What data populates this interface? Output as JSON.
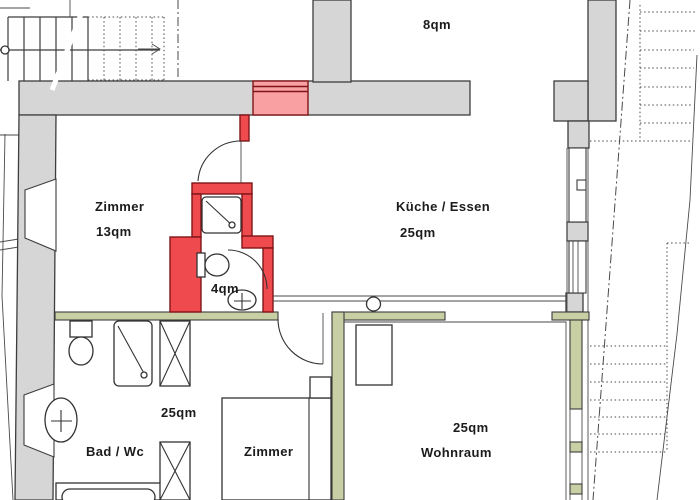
{
  "colors": {
    "bg": "#ffffff",
    "wall": "#d6d6d6",
    "green": "#c9cfa5",
    "red": "#ef4a4d",
    "pink": "#f9a0a2"
  },
  "rooms": {
    "attic": {
      "area": "8qm"
    },
    "zimmer13": {
      "name": "Zimmer",
      "area": "13qm"
    },
    "kueche": {
      "name": "Küche / Essen",
      "area": "25qm"
    },
    "bad4": {
      "area": "4qm"
    },
    "bad": {
      "name": "Bad / Wc",
      "area": "25qm"
    },
    "zimmer2": {
      "name": "Zimmer"
    },
    "wohnraum": {
      "name": "Wohnraum",
      "area": "25qm"
    }
  }
}
